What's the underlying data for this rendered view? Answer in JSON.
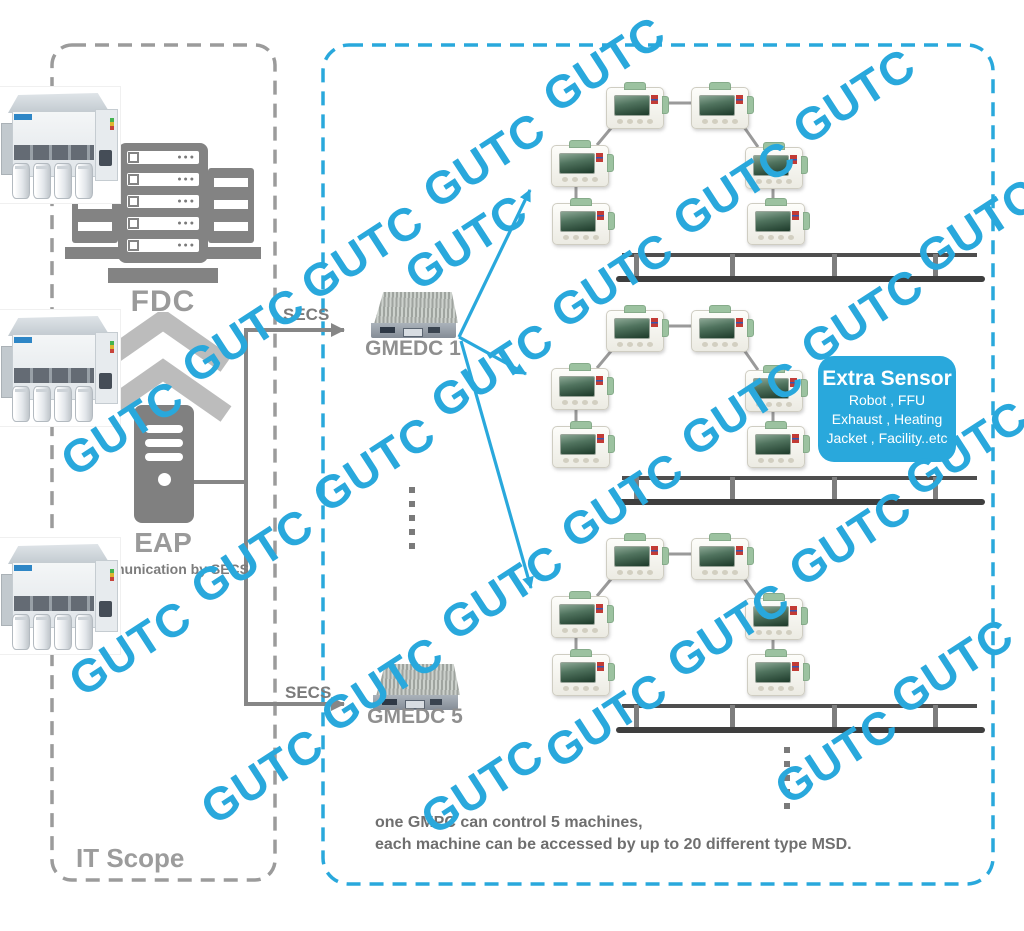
{
  "colors": {
    "accent_blue": "#29a8dc",
    "icon_gray": "#838383",
    "label_gray": "#9a9a9a"
  },
  "it_scope": {
    "label": "IT Scope",
    "fdc_label": "FDC",
    "eap_label": "EAP",
    "eap_caption": "Communication by SECS"
  },
  "links": {
    "secs_top": "SECS",
    "secs_bottom": "SECS"
  },
  "gmedc": {
    "g1_label": "GMEDC 1",
    "g5_label": "GMEDC 5"
  },
  "extra_sensor": {
    "title": "Extra Sensor",
    "lines": [
      "Robot , FFU",
      "Exhaust , Heating",
      "Jacket , Facility..etc"
    ]
  },
  "footnote": {
    "line1": "one GMPC can control 5 machines,",
    "line2": "each machine can be accessed by up to 20 different type MSD."
  },
  "watermark": {
    "text": "GUTC",
    "color": "#29a8dc",
    "positions": [
      [
        122,
        428
      ],
      [
        243,
        335
      ],
      [
        362,
        252
      ],
      [
        484,
        160
      ],
      [
        604,
        64
      ],
      [
        130,
        648
      ],
      [
        252,
        556
      ],
      [
        374,
        464
      ],
      [
        492,
        370
      ],
      [
        612,
        280
      ],
      [
        734,
        188
      ],
      [
        854,
        96
      ],
      [
        262,
        776
      ],
      [
        382,
        684
      ],
      [
        502,
        592
      ],
      [
        622,
        500
      ],
      [
        742,
        408
      ],
      [
        862,
        316
      ],
      [
        978,
        226
      ],
      [
        482,
        786
      ],
      [
        606,
        720
      ],
      [
        728,
        630
      ],
      [
        850,
        538
      ],
      [
        966,
        448
      ],
      [
        836,
        756
      ],
      [
        952,
        666
      ],
      [
        466,
        242
      ]
    ]
  }
}
